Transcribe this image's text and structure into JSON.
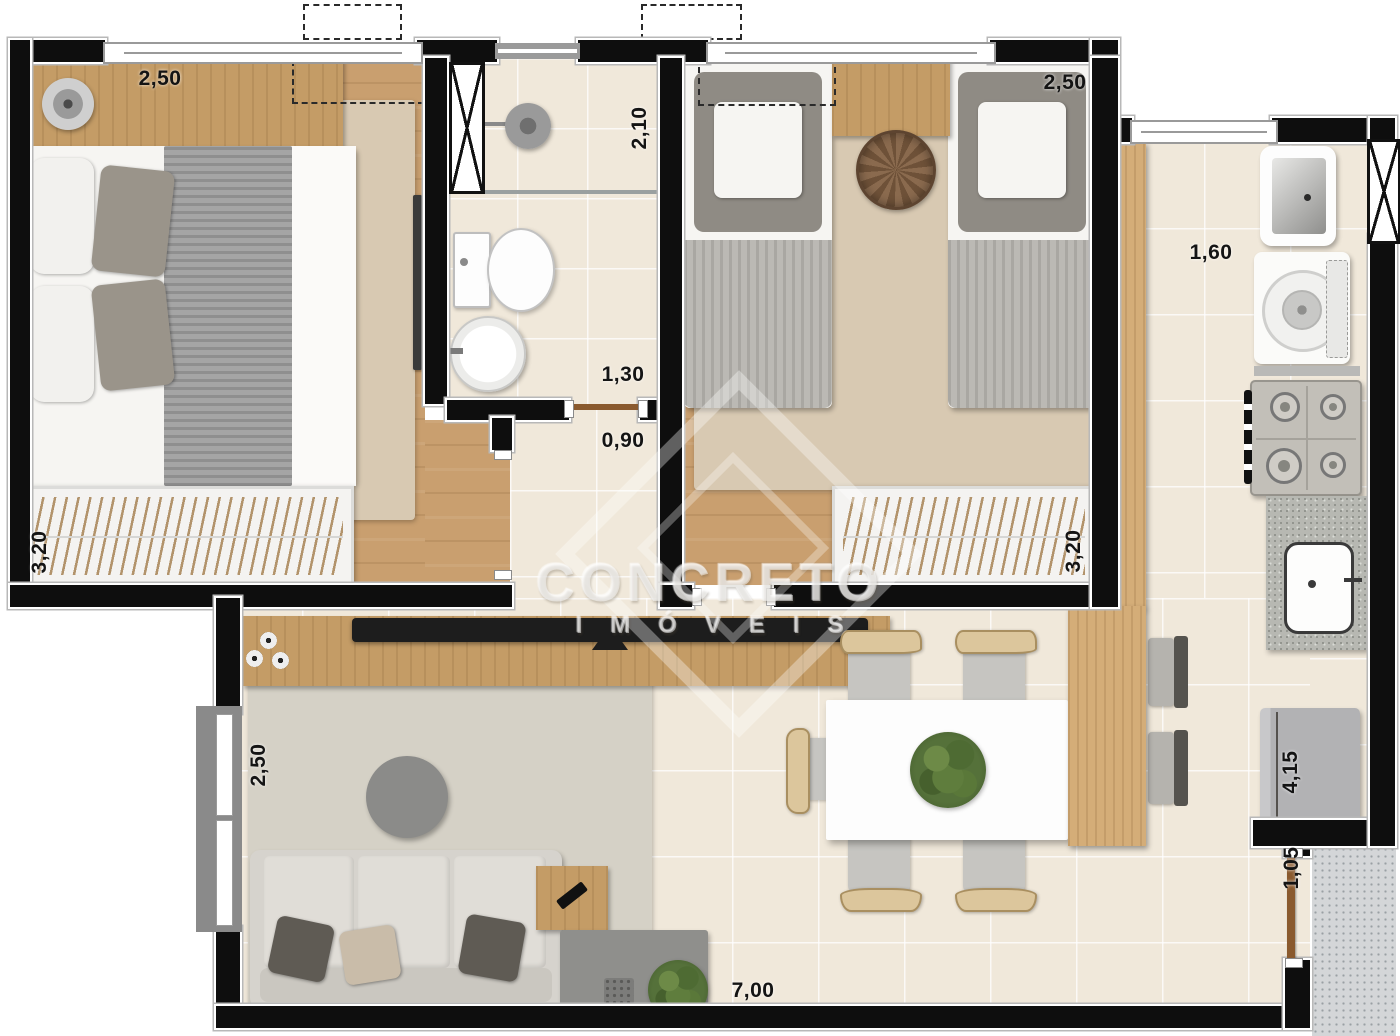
{
  "meta": {
    "type": "apartment-floor-plan"
  },
  "watermark": {
    "brand": "CONCRETO",
    "sub": "IMÓVEIS"
  },
  "colors": {
    "wall": "#0e0e0e",
    "wood_floor": "#c99f6f",
    "tile": "#f0e8da",
    "counter": "#d4ad78",
    "granite": "#b7b8b2",
    "rug_bedroom": "#d8c9b2",
    "rug_living": "#d5d1c6",
    "label": "#141414"
  },
  "labels": {
    "bedroom1_width": "2,50",
    "bedroom1_length": "3,20",
    "bathroom_length": "2,10",
    "bathroom_width": "1,30",
    "hall_width": "0,90",
    "bedroom2_width": "2,50",
    "bedroom2_length": "3,20",
    "kitchen_width": "1,60",
    "kitchen_length": "4,15",
    "entry_width": "1,05",
    "living_width": "2,50",
    "living_length": "7,00"
  }
}
